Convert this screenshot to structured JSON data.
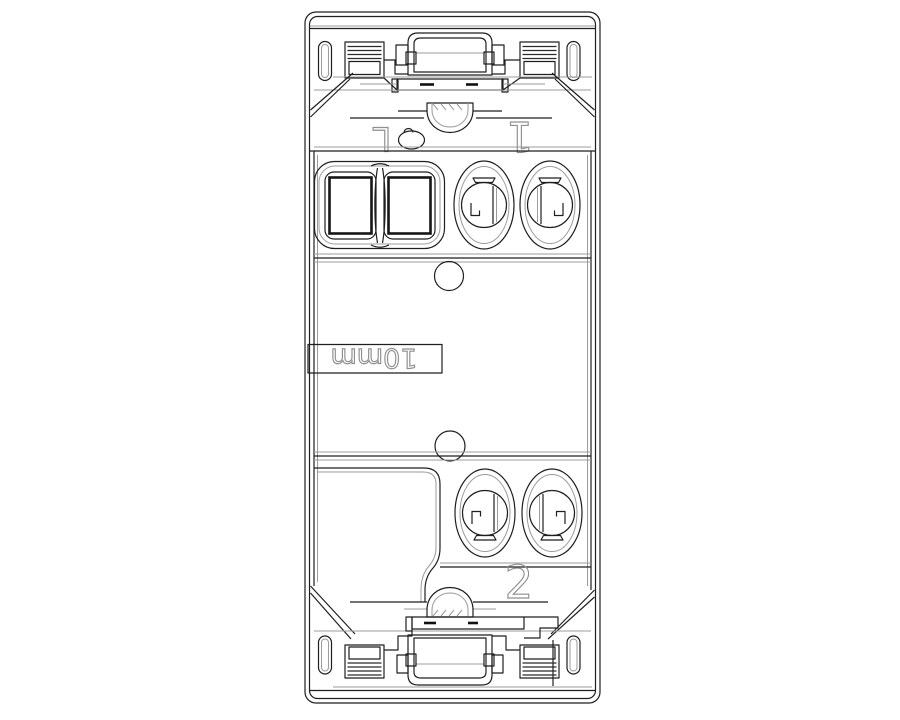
{
  "drawing": {
    "background": "#ffffff",
    "stroke_main": "#1f1f1f",
    "stroke_soft": "#9b9b9b",
    "text_outline_color": "#8f8f8f",
    "labels": {
      "pole_l": "L",
      "pole_1": "1",
      "pole_2": "2",
      "strip_gauge": "10mm"
    }
  }
}
